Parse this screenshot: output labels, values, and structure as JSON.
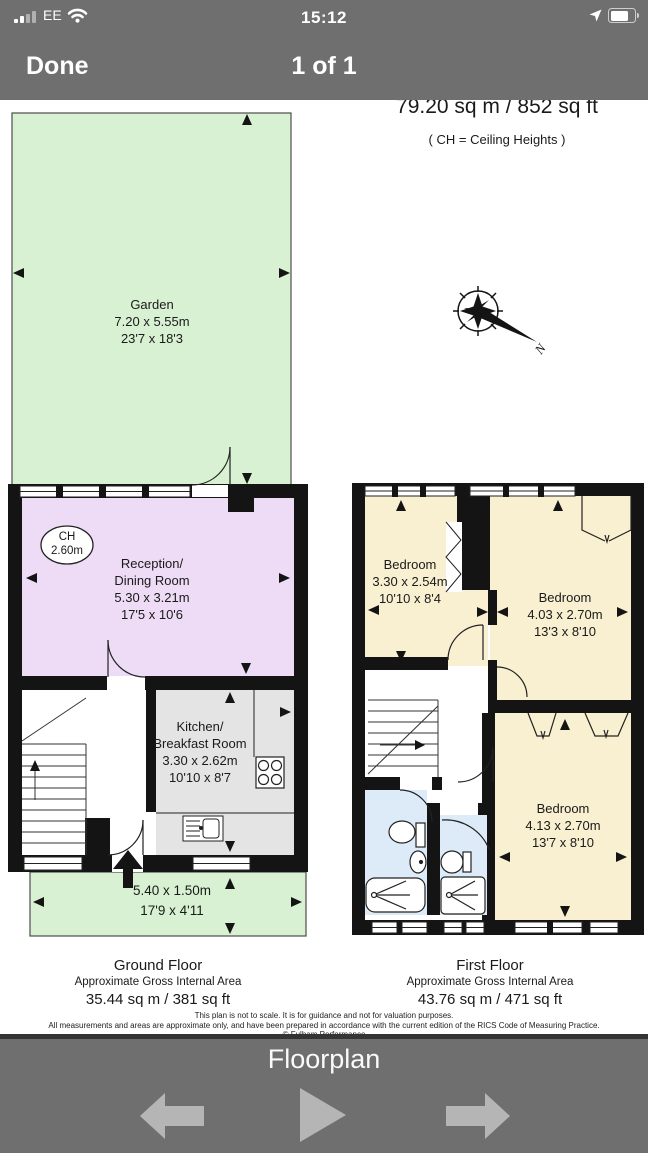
{
  "status_bar": {
    "carrier": "EE",
    "time": "15:12"
  },
  "nav_bar": {
    "done_label": "Done",
    "page_indicator": "1 of 1"
  },
  "header": {
    "title": "Campbell House, SW1V",
    "subtitle": "Approximate Gross Internal Area",
    "area": "79.20 sq m  /  852 sq ft",
    "note": "( CH = Ceiling Heights )"
  },
  "compass": {
    "north": "N"
  },
  "ground": {
    "garden": {
      "name": "Garden",
      "metric": "7.20 x 5.55m",
      "imperial": "23'7 x 18'3"
    },
    "ceiling": {
      "label": "CH",
      "value": "2.60m"
    },
    "reception": {
      "name_line1": "Reception/",
      "name_line2": "Dining Room",
      "metric": "5.30 x 3.21m",
      "imperial": "17'5 x 10'6"
    },
    "kitchen": {
      "name_line1": "Kitchen/",
      "name_line2": "Breakfast Room",
      "metric": "3.30 x 2.62m",
      "imperial": "10'10 x 8'7"
    },
    "front_garden": {
      "metric": "5.40 x 1.50m",
      "imperial": "17'9 x 4'11"
    },
    "label": {
      "name": "Ground Floor",
      "subtitle": "Approximate Gross Internal Area",
      "area": "35.44 sq m  /  381 sq ft"
    }
  },
  "first": {
    "bedroom1": {
      "name": "Bedroom",
      "metric": "3.30 x 2.54m",
      "imperial": "10'10 x 8'4"
    },
    "bedroom2": {
      "name": "Bedroom",
      "metric": "4.03 x 2.70m",
      "imperial": "13'3 x 8'10"
    },
    "bedroom3": {
      "name": "Bedroom",
      "metric": "4.13 x 2.70m",
      "imperial": "13'7 x 8'10"
    },
    "label": {
      "name": "First Floor",
      "subtitle": "Approximate Gross Internal Area",
      "area": "43.76 sq m  /  471 sq ft"
    }
  },
  "disclaimer": {
    "line1": "This plan is not to scale. It is for guidance and not for valuation purposes.",
    "line2": "All measurements and areas are approximate only, and have been prepared in accordance with the current edition of the RICS Code of Measuring Practice.",
    "line3": "© Fulham Performance"
  },
  "toolbar": {
    "title": "Floorplan"
  },
  "colors": {
    "chrome_gray": "#6f6f6f",
    "garden_green": "#d9f1d3",
    "reception_lavender": "#eedcf6",
    "kitchen_gray": "#e4e4e4",
    "bedroom_cream": "#f8f0d0",
    "bathroom_blue": "#dcebf7",
    "wall_black": "#141414",
    "toolbar_arrow_gray": "#b5b5b5"
  }
}
